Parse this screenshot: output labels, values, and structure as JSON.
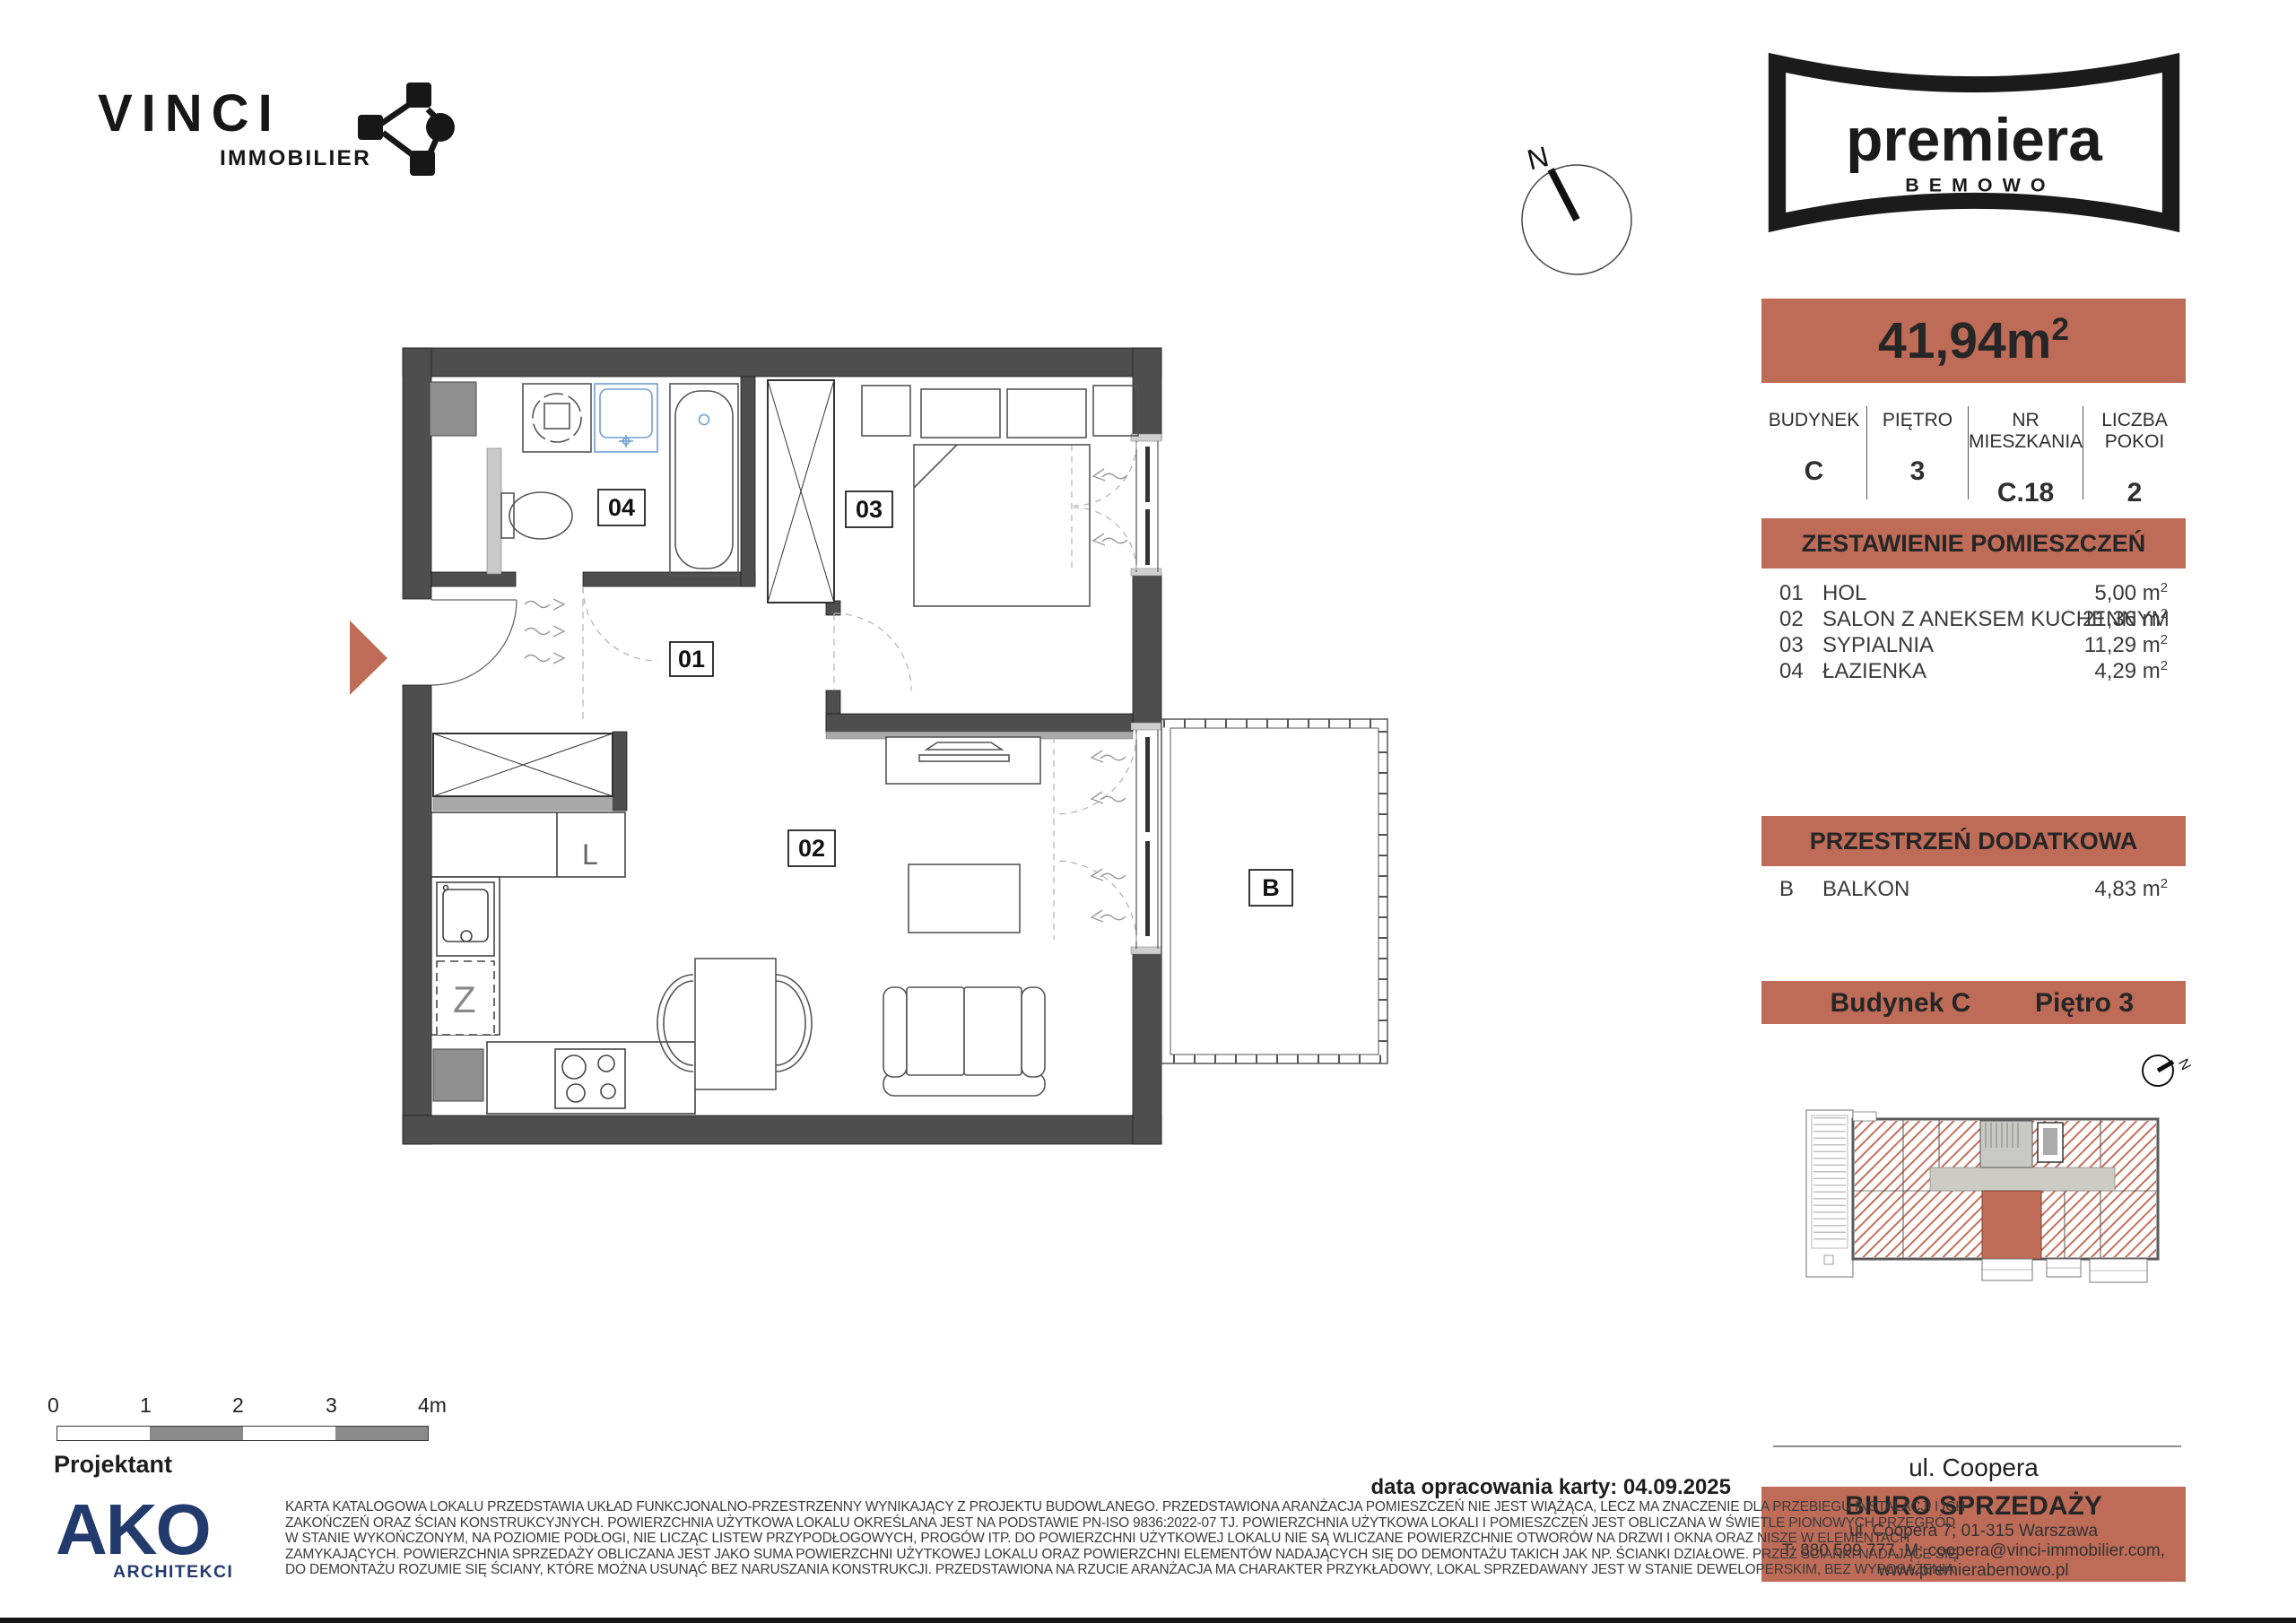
{
  "brand": {
    "name": "VINCI",
    "division": "IMMOBILIER"
  },
  "compass": {
    "north": "N"
  },
  "project": {
    "name": "premiera",
    "sub": "BEMOWO"
  },
  "unit": {
    "area_value": "41,94m",
    "area_sup": "2",
    "info": {
      "headers": [
        "BUDYNEK",
        "PIĘTRO",
        "NR MIESZKANIA",
        "LICZBA POKOI"
      ],
      "values": [
        "C",
        "3",
        "C.18",
        "2"
      ]
    }
  },
  "rooms": {
    "title": "ZESTAWIENIE POMIESZCZEŃ",
    "rows": [
      {
        "num": "01",
        "name": "HOL",
        "area": "5,00 m",
        "sup": "2"
      },
      {
        "num": "02",
        "name": "SALON Z ANEKSEM KUCHENNYM",
        "area": "21,36 m",
        "sup": "2"
      },
      {
        "num": "03",
        "name": "SYPIALNIA",
        "area": "11,29 m",
        "sup": "2"
      },
      {
        "num": "04",
        "name": "ŁAZIENKA",
        "area": "4,29 m",
        "sup": "2"
      }
    ]
  },
  "extra": {
    "title": "PRZESTRZEŃ DODATKOWA",
    "rows": [
      {
        "num": "B",
        "name": "BALKON",
        "area": "4,83 m",
        "sup": "2"
      }
    ]
  },
  "location": {
    "building": "Budynek  C",
    "floor": "Piętro 3"
  },
  "street": "ul. Coopera",
  "office": {
    "title": "BIURO SPRZEDAŻY",
    "line1": "ul. Coopera  7; 01-315 Warszawa",
    "line2": "T: 880 599 777, M: coopera@vinci-immobilier.com,",
    "line3": "www.premierabemowo.pl"
  },
  "date_line": "data opracowania karty: 04.09.2025",
  "designer": {
    "label": "Projektant",
    "studio": "AKO",
    "studio_sub": "ARCHITEKCI"
  },
  "scale": {
    "labels": [
      "0",
      "1",
      "2",
      "3",
      "4m"
    ]
  },
  "plan": {
    "labels": {
      "hall": "01",
      "living": "02",
      "bedroom": "03",
      "bath": "04",
      "balcony": "B"
    },
    "fixtures": {
      "fridge": "L",
      "dishwasher": "Z"
    }
  },
  "disclaimer": {
    "lines": [
      "KARTA KATALOGOWA LOKALU PRZEDSTAWIA UKŁAD FUNKCJONALNO-PRZESTRZENNY WYNIKAJĄCY Z PROJEKTU BUDOWLANEGO. PRZEDSTAWIONA ARANŻACJA POMIESZCZEŃ NIE JEST WIĄŻĄCA, LECZ MA ZNACZENIE DLA PRZEBIEGU INSTALACJI I ICH",
      "ZAKOŃCZEŃ ORAZ ŚCIAN KONSTRUKCYJNYCH. POWIERZCHNIA UŻYTKOWA LOKALU OKREŚLANA JEST NA PODSTAWIE PN-ISO 9836:2022-07 TJ. POWIERZCHNIA UŻYTKOWA LOKALI I POMIESZCZEŃ JEST OBLICZANA W ŚWIETLE PIONOWYCH PRZEGRÓD",
      "W STANIE WYKOŃCZONYM, NA POZIOMIE PODŁOGI, NIE LICZĄC LISTEW PRZYPODŁOGOWYCH, PROGÓW ITP. DO POWIERZCHNI UŻYTKOWEJ LOKALU NIE SĄ WLICZANE POWIERZCHNIE OTWORÓW NA DRZWI I OKNA ORAZ NISZE W ELEMENTACH",
      "ZAMYKAJĄCYCH. POWIERZCHNIA SPRZEDAŻY OBLICZANA JEST JAKO SUMA POWIERZCHNI UŻYTKOWEJ LOKALU ORAZ POWIERZCHNI ELEMENTÓW NADAJĄCYCH SIĘ DO DEMONTAŻU TAKICH JAK NP. ŚCIANKI DZIAŁOWE. PRZEZ ŚCIANKI NADAJĄCE SIĘ",
      "DO DEMONTAŻU ROZUMIE SIĘ ŚCIANY, KTÓRE MOŻNA USUNĄĆ BEZ NARUSZANIA KONSTRUKCJI. PRZEDSTAWIONA NA RZUCIE ARANŻACJA MA CHARAKTER PRZYKŁADOWY, LOKAL SPRZEDAWANY JEST W STANIE DEWELOPERSKIM, BEZ WYPOSAŻENIA"
    ]
  },
  "colors": {
    "accent": "#BE6C58",
    "wall": "#4E4E4E",
    "navy": "#233A6C"
  }
}
